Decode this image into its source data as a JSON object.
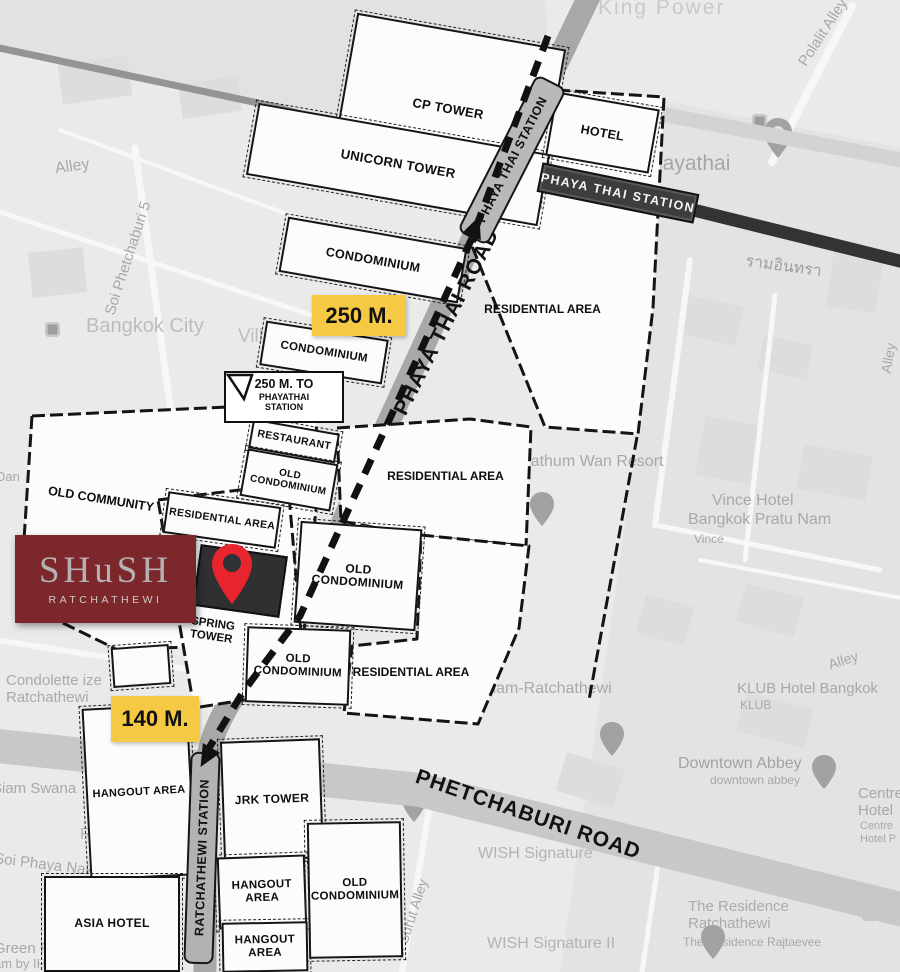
{
  "site": {
    "brand": "SHuSH",
    "brand_sub": "RATCHATHEWI"
  },
  "badges": {
    "to_phayathai": "250 M.",
    "to_ratchathewi": "140 M."
  },
  "callout": {
    "line1": "250 M. TO",
    "line2": "PHAYATHAI",
    "line3": "STATION"
  },
  "roads": {
    "phaya_thai": "PHAYA THAI ROAD",
    "phetchaburi": "PHETCHABURI ROAD"
  },
  "stations": {
    "phaya_thai_capsule": "PHAYA THAI STATION",
    "phaya_thai_bar": "PHAYA THAI STATION",
    "ratchathewi_capsule": "RATCHATHEWI STATION"
  },
  "buildings": [
    {
      "label": "CP TOWER"
    },
    {
      "label": "UNICORN TOWER"
    },
    {
      "label": "CONDOMINIUM"
    },
    {
      "label": "HOTEL"
    },
    {
      "label": "CONDOMINIUM"
    },
    {
      "label": "RESTAURANT"
    },
    {
      "label": "OLD\nCONDOMINIUM"
    },
    {
      "label": "RESIDENTIAL AREA"
    },
    {
      "label": "SPRING\nTOWER"
    },
    {
      "label": "OLD\nCONDOMINIUM"
    },
    {
      "label": "OLD\nCONDOMINIUM"
    },
    {
      "label": "HANGOUT AREA"
    },
    {
      "label": "JRK TOWER"
    },
    {
      "label": "HANGOUT\nAREA"
    },
    {
      "label": "OLD\nCONDOMINIUM"
    },
    {
      "label": "HANGOUT\nAREA"
    },
    {
      "label": "ASIA HOTEL"
    }
  ],
  "area_labels": [
    {
      "label": "OLD COMMUNITY"
    },
    {
      "label": "RESIDENTIAL AREA"
    },
    {
      "label": "RESIDENTIAL AREA"
    },
    {
      "label": "RESIDENTIAL AREA"
    }
  ],
  "map_labels": [
    {
      "text": "King Power"
    },
    {
      "text": "Polalit Alley"
    },
    {
      "text": "Alley"
    },
    {
      "text": "Soi Phetchaburi 5"
    },
    {
      "text": "Bangkok City"
    },
    {
      "text": "Vill"
    },
    {
      "text": "Phayathai"
    },
    {
      "text": "รามอินทรา"
    },
    {
      "text": "Pathum Wan Resort"
    },
    {
      "text": "Vince Hotel"
    },
    {
      "text": "Bangkok Pratu Nam"
    },
    {
      "text": "Vince"
    },
    {
      "text": "Alley"
    },
    {
      "text": "KLUB Hotel Bangkok"
    },
    {
      "text": "KLUB"
    },
    {
      "text": "Downtown Abbey"
    },
    {
      "text": "downtown abbey"
    },
    {
      "text": "Centre\nHotel"
    },
    {
      "text": "Centre\nHotel P"
    },
    {
      "text": "Q Siam-Ratchathewi"
    },
    {
      "text": "THE"
    },
    {
      "text": "WISH Signature"
    },
    {
      "text": "WISH Signature II"
    },
    {
      "text": "The Residence\nRatchathewi"
    },
    {
      "text": "The Residence Rajtaevee"
    },
    {
      "text": "Si Surut Alley"
    },
    {
      "text": "Soi Phaya Nak"
    },
    {
      "text": "Siam Swana"
    },
    {
      "text": "Condolette ize\nRatchathewi"
    },
    {
      "text": "Ratchathewi"
    },
    {
      "text": "ราชเทวี"
    },
    {
      "text": "Green Place"
    },
    {
      "text": "am by IHG"
    },
    {
      "text": "Dan"
    },
    {
      "text": "Alley"
    }
  ],
  "icons": {
    "site_pin": "location-pin",
    "gray_pin": "map-pin",
    "poi_square": "poi-icon"
  },
  "colors": {
    "accent_yellow": "#f6c945",
    "brand_maroon": "#7c272b",
    "pin_red": "#e8242c",
    "bar_dark": "#3d3d3d"
  }
}
